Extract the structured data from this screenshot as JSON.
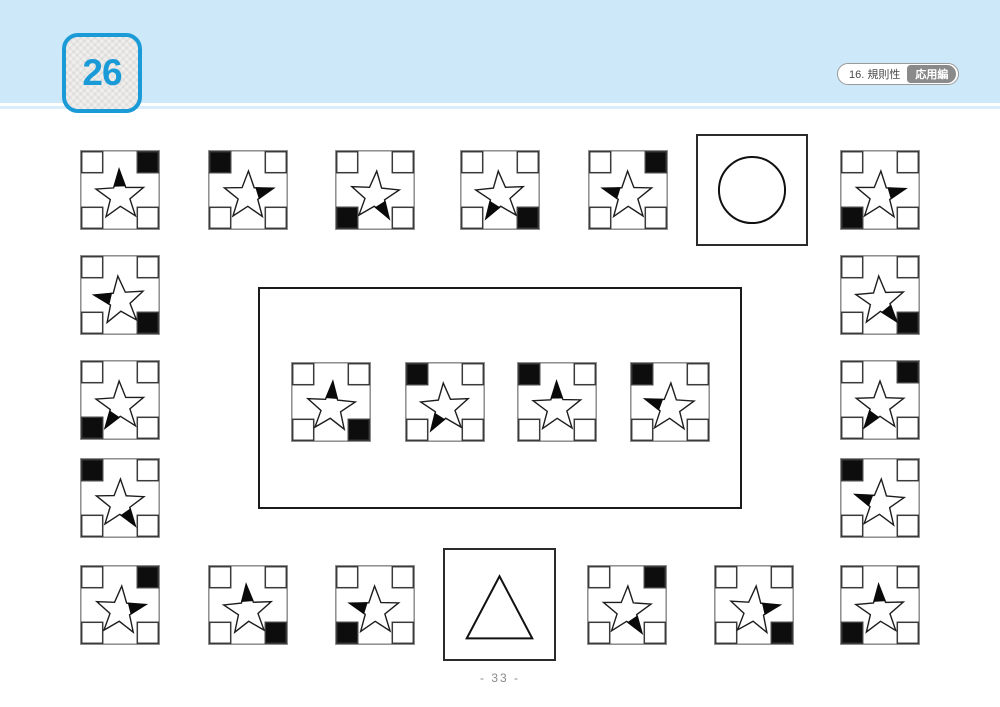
{
  "header": {
    "badge_number": "26",
    "accent_color": "#1a9bd7",
    "band_color": "#cde8f8",
    "underline_color": "#d9edfa",
    "tag": {
      "category": "16. 規則性",
      "level": "応用編",
      "level_bg": "#8a8a8a"
    }
  },
  "footer": {
    "page_number": "- 33 -"
  },
  "puzzle": {
    "tile_legend": "Each small card: 4 corner squares (one filled black) and a star with one black wedge on one of its five points.",
    "regions": {
      "top_row": [
        {
          "black_corner": "top-right",
          "wedge_point": "top"
        },
        {
          "black_corner": "top-left",
          "wedge_point": "upper-right"
        },
        {
          "black_corner": "bottom-left",
          "wedge_point": "lower-right"
        },
        {
          "black_corner": "bottom-right",
          "wedge_point": "lower-left"
        },
        {
          "black_corner": "top-right",
          "wedge_point": "upper-left"
        },
        {
          "black_corner": "bottom-left",
          "wedge_point": "upper-right"
        }
      ],
      "left_column": [
        {
          "black_corner": "bottom-right",
          "wedge_point": "upper-left"
        },
        {
          "black_corner": "bottom-left",
          "wedge_point": "lower-left"
        },
        {
          "black_corner": "top-left",
          "wedge_point": "lower-right"
        }
      ],
      "right_column": [
        {
          "black_corner": "bottom-right",
          "wedge_point": "lower-right"
        },
        {
          "black_corner": "top-right",
          "wedge_point": "lower-left"
        },
        {
          "black_corner": "top-left",
          "wedge_point": "upper-left"
        }
      ],
      "center_box": [
        {
          "black_corner": "bottom-right",
          "wedge_point": "top"
        },
        {
          "black_corner": "top-left",
          "wedge_point": "lower-left"
        },
        {
          "black_corner": "top-left",
          "wedge_point": "top"
        },
        {
          "black_corner": "top-left",
          "wedge_point": "upper-left"
        }
      ],
      "bottom_row": [
        {
          "black_corner": "top-right",
          "wedge_point": "upper-right"
        },
        {
          "black_corner": "bottom-right",
          "wedge_point": "top"
        },
        {
          "black_corner": "bottom-left",
          "wedge_point": "upper-left"
        },
        {
          "black_corner": "top-right",
          "wedge_point": "lower-right"
        },
        {
          "black_corner": "bottom-right",
          "wedge_point": "upper-right"
        },
        {
          "black_corner": "bottom-left",
          "wedge_point": "top"
        }
      ]
    },
    "shape_boxes": [
      {
        "shape": "circle"
      },
      {
        "shape": "triangle"
      }
    ]
  }
}
